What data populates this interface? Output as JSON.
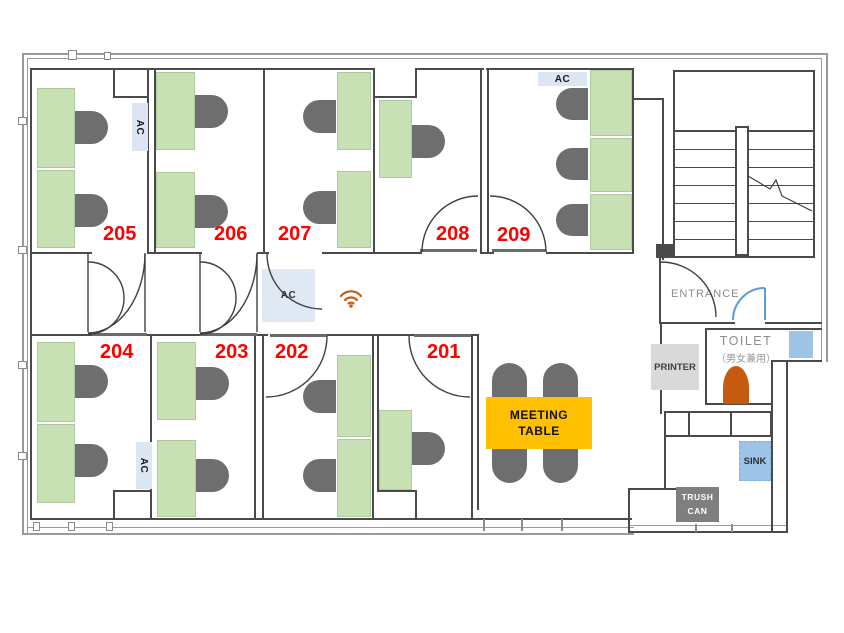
{
  "rooms": {
    "r201": "201",
    "r202": "202",
    "r203": "203",
    "r204": "204",
    "r205": "205",
    "r206": "206",
    "r207": "207",
    "r208": "208",
    "r209": "209"
  },
  "labels": {
    "ac": "AC",
    "entrance": "ENTRANCE",
    "toilet_title": "TOILET",
    "toilet_subtitle": "（男女兼用）",
    "printer": "PRINTER",
    "sink": "SINK",
    "trash_line1": "TRUSH",
    "trash_line2": "CAN",
    "meeting_line1": "MEETING",
    "meeting_line2": "TABLE"
  },
  "icons": {
    "wifi": "wifi-signal-icon"
  },
  "colors": {
    "desk_green": "#c7e1b5",
    "chair_gray": "#6e6e6e",
    "meeting_table_yellow": "#ffc000",
    "room_label_red": "#fe0000",
    "ac_panel_blue": "#dce6f2",
    "window_blue": "#9dc3e6",
    "door_blue": "#5b9bd5",
    "toilet_fixture_orange": "#c55a11",
    "wifi_orange": "#c55a11",
    "wall_dark": "#4a4a4a",
    "printer_gray": "#d9d9d9",
    "trash_gray": "#7f7f7f"
  }
}
